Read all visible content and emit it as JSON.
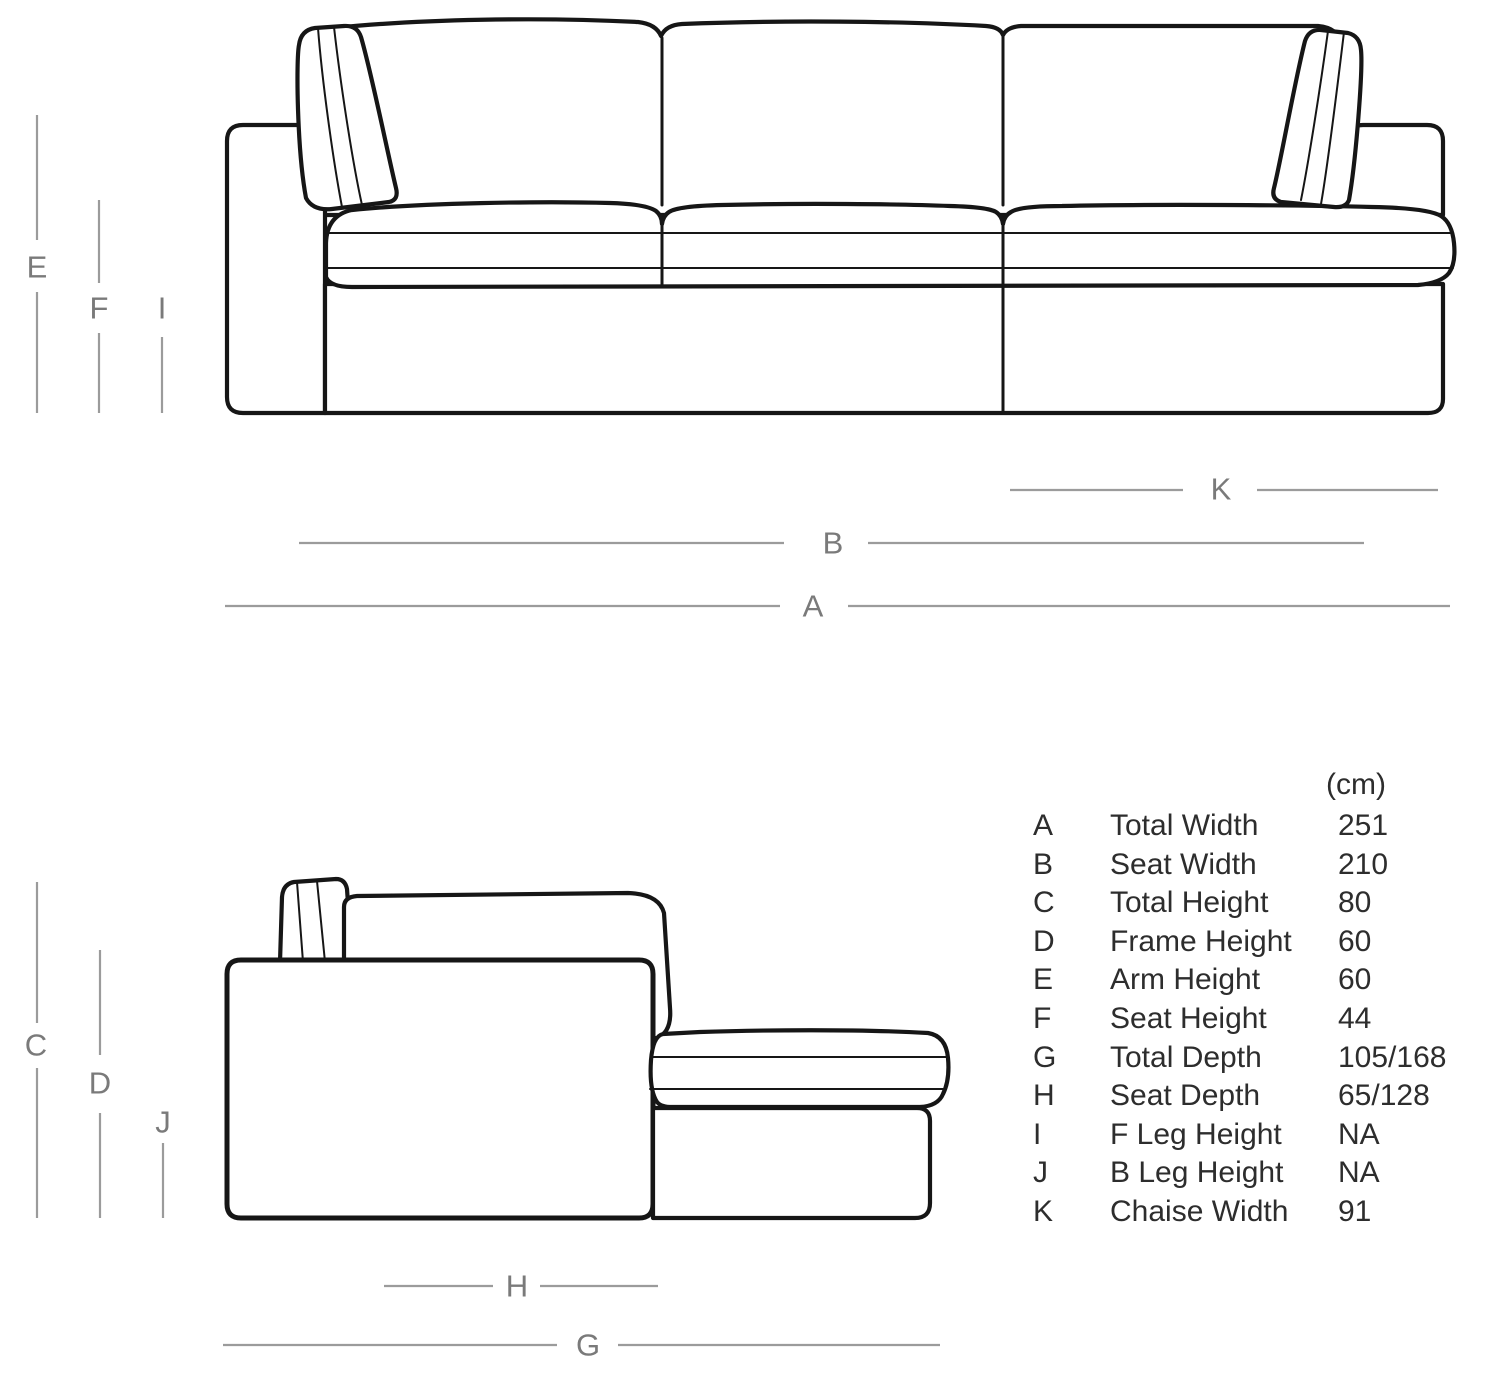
{
  "diagram": {
    "labels": {
      "A": "A",
      "B": "B",
      "C": "C",
      "D": "D",
      "E": "E",
      "F": "F",
      "G": "G",
      "H": "H",
      "I": "I",
      "J": "J",
      "K": "K"
    }
  },
  "table": {
    "unit": "(cm)",
    "rows": [
      {
        "letter": "A",
        "name": "Total Width",
        "value": "251"
      },
      {
        "letter": "B",
        "name": "Seat Width",
        "value": "210"
      },
      {
        "letter": "C",
        "name": "Total Height",
        "value": "80"
      },
      {
        "letter": "D",
        "name": "Frame Height",
        "value": "60"
      },
      {
        "letter": "E",
        "name": "Arm Height",
        "value": "60"
      },
      {
        "letter": "F",
        "name": "Seat Height",
        "value": "44"
      },
      {
        "letter": "G",
        "name": "Total Depth",
        "value": "105/168"
      },
      {
        "letter": "H",
        "name": "Seat Depth",
        "value": "65/128"
      },
      {
        "letter": "I",
        "name": "F Leg Height",
        "value": "NA"
      },
      {
        "letter": "J",
        "name": "B Leg Height",
        "value": "NA"
      },
      {
        "letter": "K",
        "name": "Chaise Width",
        "value": "91"
      }
    ]
  },
  "colors": {
    "line-color": "#161616",
    "dim-line-color": "#9b9b9b",
    "dim-label-color": "#7a7a7a",
    "table-text-color": "#2d2d2d"
  }
}
